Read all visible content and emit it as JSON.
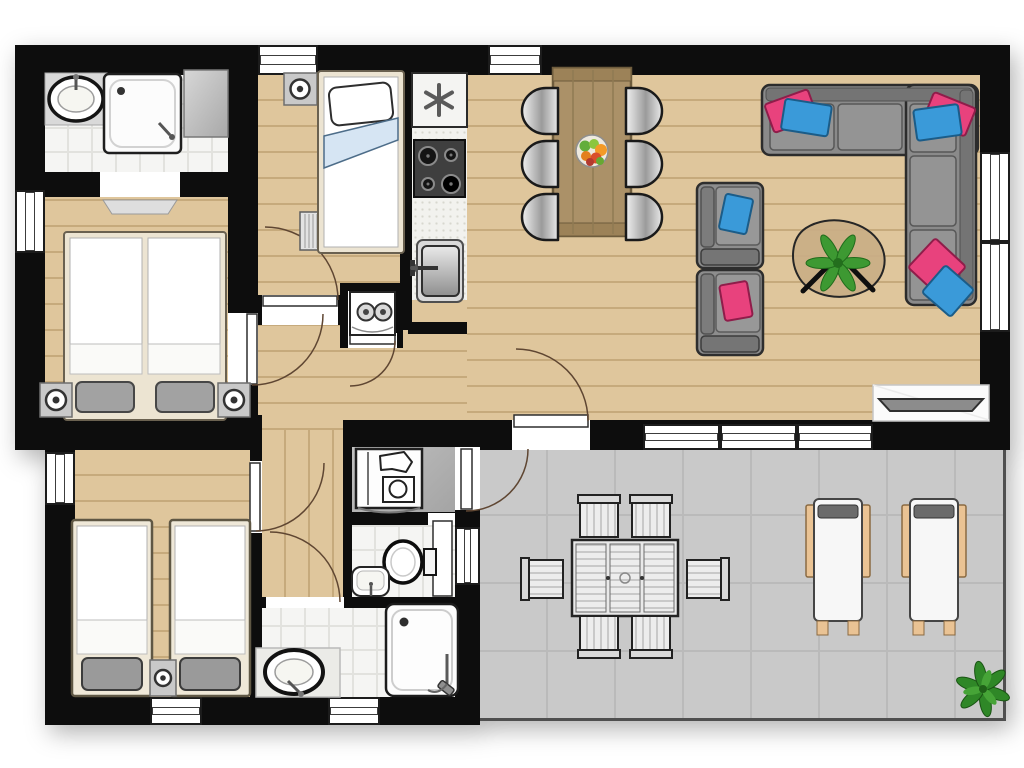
{
  "title": "holiday-home-floor-plan",
  "colors": {
    "wall": "#0d0d0d",
    "wood": "#dfc69c",
    "wood_line": "#c6aa7c",
    "tile": "#f5f5f3",
    "tile_line": "#e2e2de",
    "terrace": "#c9c9c9",
    "terrace_line": "#bababa",
    "concrete": "#b5b5b5",
    "sofa": "#8a8a8a",
    "accent_pink": "#e8427d",
    "accent_blue": "#3a9ad9",
    "plant": "#3d9932",
    "lounger_wood": "#eac394"
  },
  "rooms": [
    {
      "name": "ensuite-bathroom",
      "floor": "tile",
      "furniture": [
        "washbasin",
        "shower",
        "wardrobe",
        "doormat"
      ]
    },
    {
      "name": "bedroom-double",
      "floor": "wood",
      "furniture": [
        "double-bed",
        "nightstand-with-lamp",
        "nightstand-with-lamp"
      ]
    },
    {
      "name": "bedroom-single",
      "floor": "wood",
      "furniture": [
        "single-bed",
        "nightstand-with-lamp",
        "radiator"
      ]
    },
    {
      "name": "kitchen",
      "floor": "counter",
      "furniture": [
        "fridge-freezer",
        "gas-hob",
        "kitchen-sink"
      ]
    },
    {
      "name": "living-dining-room",
      "floor": "wood",
      "furniture": [
        "dining-table",
        "six-dining-chairs",
        "fruit-bowl",
        "armchair-with-blue-cushion",
        "armchair-with-pink-cushion",
        "coffee-table-with-plant",
        "corner-sofa-with-cushions",
        "tv-console"
      ]
    },
    {
      "name": "corridor",
      "floor": "wood",
      "furniture": []
    },
    {
      "name": "hallway",
      "floor": "wood",
      "furniture": []
    },
    {
      "name": "utility-closet",
      "floor": "concrete",
      "furniture": [
        "washing-machine"
      ]
    },
    {
      "name": "boiler-closet",
      "floor": "white",
      "furniture": [
        "boiler"
      ]
    },
    {
      "name": "wc",
      "floor": "tile",
      "furniture": [
        "toilet",
        "hand-basin"
      ]
    },
    {
      "name": "bathroom",
      "floor": "tile",
      "furniture": [
        "washbasin",
        "shower"
      ]
    },
    {
      "name": "bedroom-twin",
      "floor": "wood",
      "furniture": [
        "twin-bed",
        "twin-bed",
        "nightstand-with-lamp"
      ]
    },
    {
      "name": "terrace",
      "floor": "terrace-tile",
      "furniture": [
        "outdoor-dining-table",
        "six-outdoor-chairs",
        "sun-lounger",
        "sun-lounger",
        "plant"
      ]
    }
  ],
  "openings": {
    "windows": 12,
    "interior_doors": 6,
    "exterior_doors": 2
  }
}
